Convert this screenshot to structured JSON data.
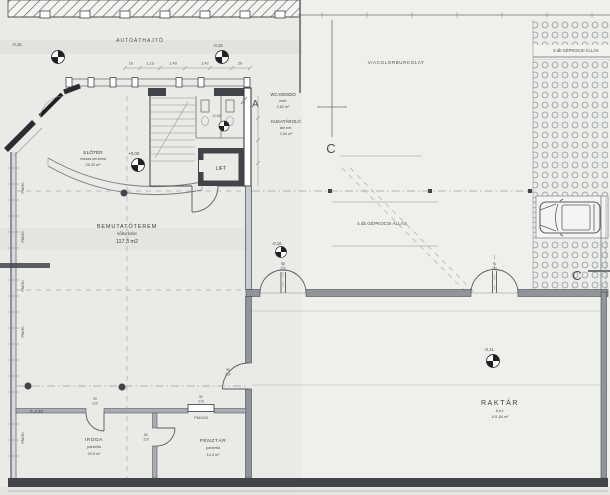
{
  "drawing": {
    "site": {
      "autoathajto": "AUTÓÁTHAJTÓ",
      "viacolorburkolat": "VIACOLORBURKOLAT",
      "parking_9": "9 db GÉPKOCSI ÁLLÁS",
      "parking_4": "4 db GÉPKOCSI ÁLLÁS"
    },
    "rooms": {
      "wc": {
        "name": "WC-MOSDÓ",
        "finish": "mett.",
        "area": "2,82 m²"
      },
      "kuka": {
        "name": "KUKATÁROLÓ",
        "finish": "sim.bet.",
        "area": "2,94 m²"
      },
      "eloter": {
        "name": "ELŐTÉR",
        "finish": "mázas kerámia",
        "area": "25,33 m²"
      },
      "lift": {
        "name": "LIFT"
      },
      "bemutatoterem": {
        "name": "BEMUTATÓTEREM",
        "finish": "kőburkolat",
        "area": "117.3 m2"
      },
      "raktar": {
        "name": "RAKTÁR",
        "finish": "b.b.f.",
        "area": "101,80 m²"
      },
      "iroda": {
        "name": "IRODA",
        "finish": "parketta",
        "area": "24,9 m²"
      },
      "penztar": {
        "name": "PÉNZTÁR",
        "finish": "parketta",
        "area": "14,3 m²"
      }
    },
    "levels": {
      "entry_left": "-0,15",
      "entry_mid": "-0,16",
      "wc": "-0,16",
      "eloter": "+0,00",
      "terrace": "-0,16",
      "raktar": "-0,11"
    },
    "sections": {
      "a": "A",
      "c": "C"
    },
    "notes": {
      "height": "h=2,40"
    },
    "door_labels": {
      "pm90": "PM/90",
      "pm100": "PM/100"
    },
    "stacks": {
      "d90": [
        "90",
        "210"
      ],
      "d80": [
        "80",
        "210"
      ]
    },
    "dims": [
      "10",
      "1,13",
      "1,40",
      "1,42",
      "20"
    ],
    "colors": {
      "ink": "#4a4e53",
      "wall_dark": "#41454a",
      "paper": "#eaeae7",
      "pattern": "#98a0a5"
    }
  }
}
